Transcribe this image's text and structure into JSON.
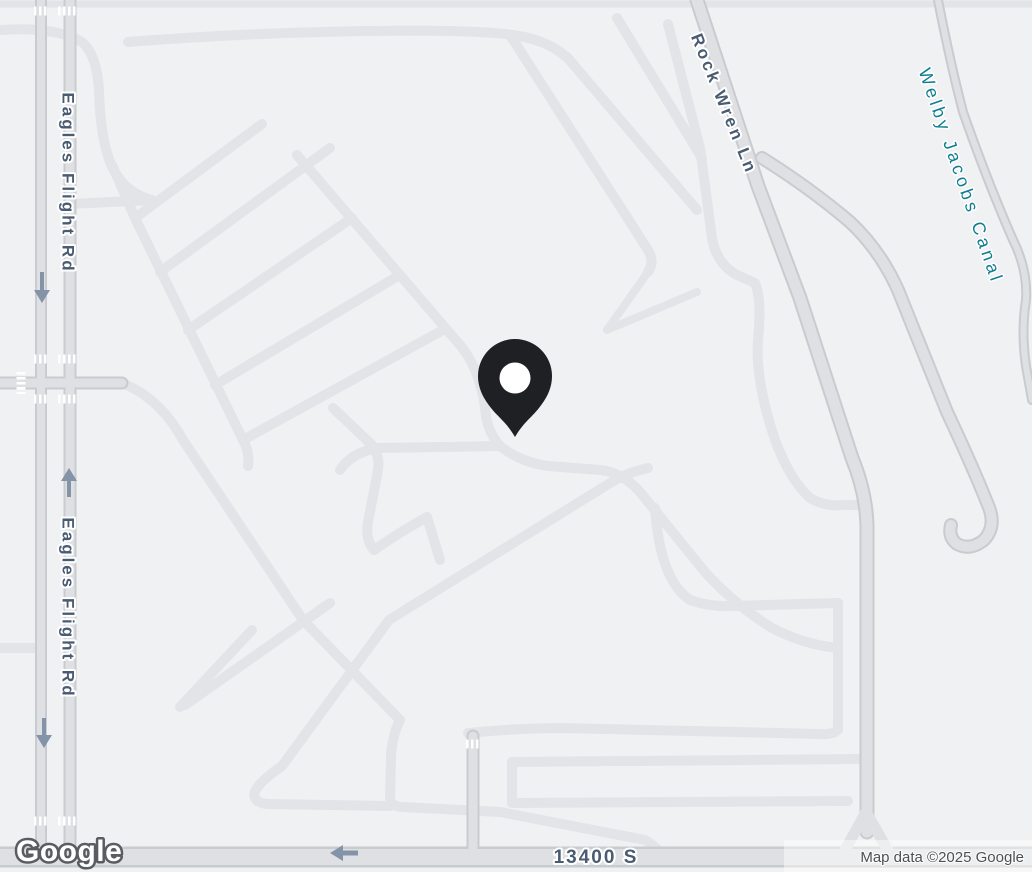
{
  "map": {
    "provider": "Google Maps",
    "view": "road-map-light",
    "labels": {
      "eagles_flight_rd_top": "Eagles Flight Rd",
      "eagles_flight_rd_bottom": "Eagles Flight Rd",
      "rock_wren_ln": "Rock Wren Ln",
      "welby_jacobs_canal": "Welby Jacobs Canal",
      "street_13400_s": "13400 S"
    },
    "marker": {
      "name": "location-pin",
      "color": "#1f2023",
      "dot_color": "#ffffff"
    },
    "icons": {
      "oneway_arrow_down_upper": "one-way-arrow-down",
      "oneway_arrow_up": "one-way-arrow-up",
      "oneway_arrow_down_lower": "one-way-arrow-down",
      "oneway_arrow_left": "one-way-arrow-left"
    },
    "colors": {
      "background": "#f0f1f3",
      "residential_road": "#e3e4e7",
      "main_road_fill": "#dfe0e3",
      "main_road_casing": "#c9cbce",
      "crosswalk": "#ffffff",
      "road_label": "#4a5c72",
      "canal_label": "#0e7e90",
      "arrow": "#8494a8",
      "attribution_text": "#4c4f53"
    },
    "footer": {
      "logo": "Google",
      "attribution": "Map data ©2025 Google"
    }
  }
}
